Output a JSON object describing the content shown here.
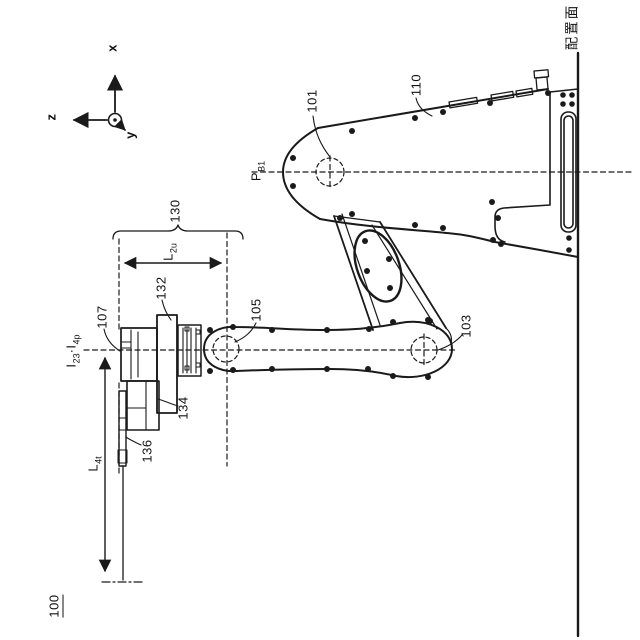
{
  "figure_labels": {
    "robot": "100",
    "first_joint": "101",
    "second_joint": "103",
    "third_joint": "105",
    "wrist": "107",
    "first_link": "110",
    "wrist_unit": "130",
    "wrist_motor": "132",
    "wrist_lower_body": "134",
    "wrist_plate": "136"
  },
  "annotations": {
    "point_b1": {
      "base": "P",
      "sub": "B1"
    },
    "dim_l2u": {
      "base": "L",
      "sub": "2u"
    },
    "dim_l4t": {
      "base": "L",
      "sub": "4t"
    },
    "axis_line": {
      "base1": "I",
      "sub1": "23",
      "sep": "·",
      "base2": "I",
      "sub2": "4p"
    },
    "mount_surface": "配置面"
  },
  "axes": {
    "x": "x",
    "y": "y",
    "z": "z"
  },
  "colors": {
    "ink": "#1a1a1a",
    "background": "#ffffff"
  }
}
